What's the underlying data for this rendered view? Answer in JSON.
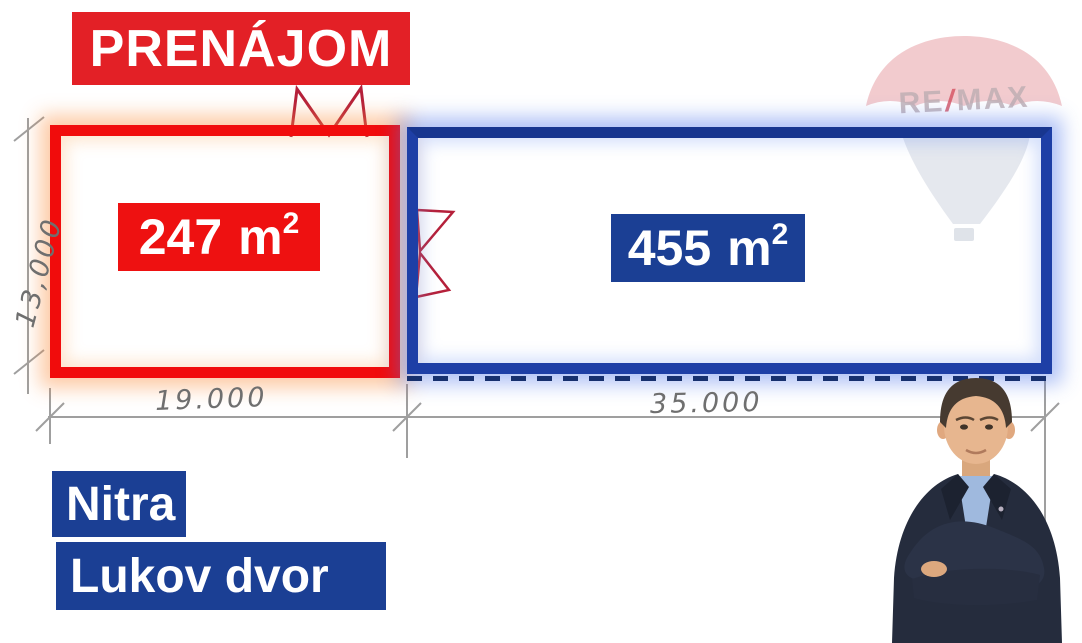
{
  "banner": {
    "label": "PRENÁJOM"
  },
  "units": [
    {
      "id": "red-unit",
      "area_number": "247",
      "unit": "m",
      "unit_exponent": "2"
    },
    {
      "id": "blue-unit",
      "area_number": "455",
      "unit": "m",
      "unit_exponent": "2"
    }
  ],
  "dimensions": {
    "left_height": "13,000",
    "red_width": "19.000",
    "blue_width": "35.000"
  },
  "location": {
    "city": "Nitra",
    "district": "Lukov dvor"
  },
  "brand": {
    "re": "RE",
    "slash": "/",
    "max": "MAX"
  },
  "colors": {
    "banner_red": "#e32026",
    "unit_red": "#ee1111",
    "unit_blue_border": "#1e3fa6",
    "label_blue": "#1b3f94",
    "door_symbol_red": "#b5203a",
    "pencil_gray": "#8f8f8f"
  }
}
